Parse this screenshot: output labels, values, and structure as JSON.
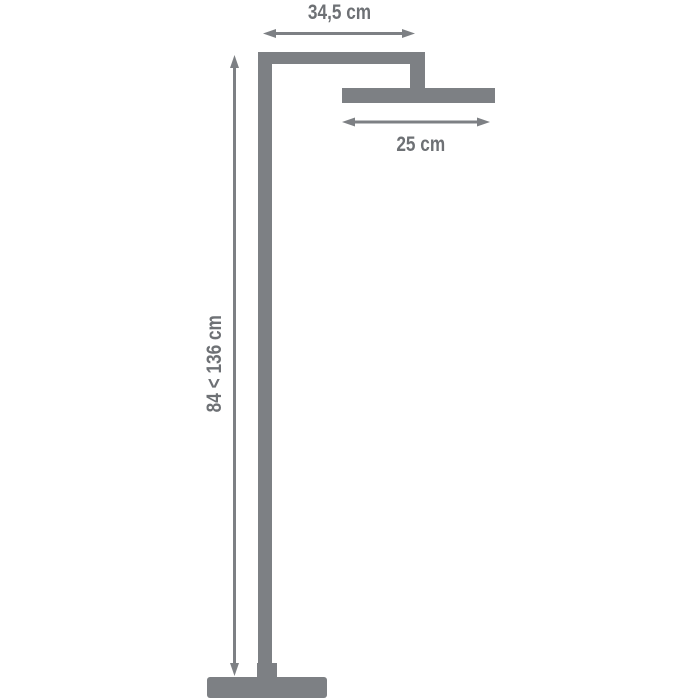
{
  "diagram": {
    "kind": "dimension-drawing",
    "subject": "freestanding shower column with square overhead shower head",
    "dimensions": {
      "top_width": "34,5 cm",
      "head_width": "25 cm",
      "height_range": "84 < 136 cm"
    },
    "colors": {
      "structure": "#7d8084",
      "text": "#6e7175",
      "background": "#ffffff"
    }
  }
}
